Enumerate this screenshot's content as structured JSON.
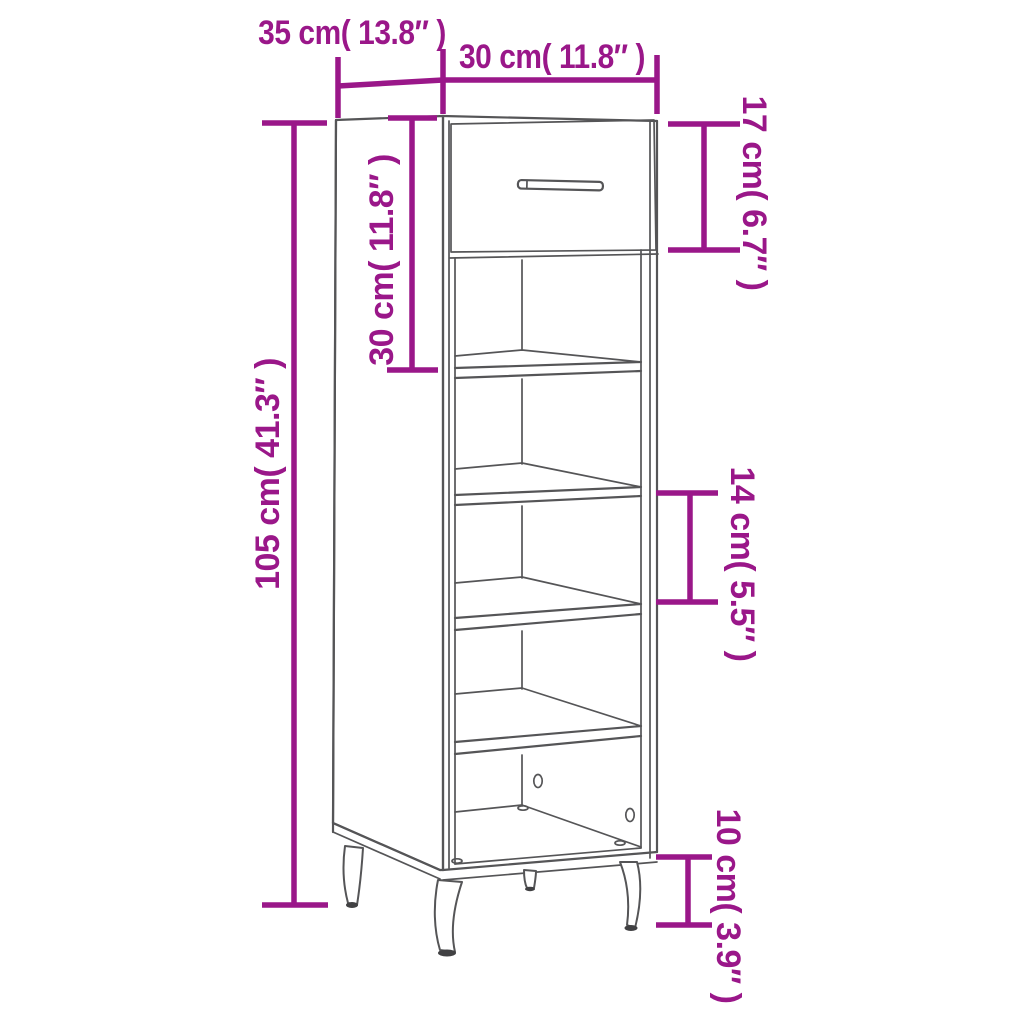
{
  "colors": {
    "accent": "#9A1789",
    "line": "#555557",
    "leg_foot": "#414143",
    "background": "#FFFFFF"
  },
  "dimensions": {
    "depth": "35 cm( 13.8″ )",
    "width": "30 cm( 11.8″ )",
    "drawer_front_height": "17 cm( 6.7″ )",
    "upper_section_height": "30 cm( 11.8″ )",
    "total_height": "105 cm( 41.3″ )",
    "shelf_gap": "14 cm( 5.5″ )",
    "leg_height": "10 cm( 3.9″ )"
  }
}
